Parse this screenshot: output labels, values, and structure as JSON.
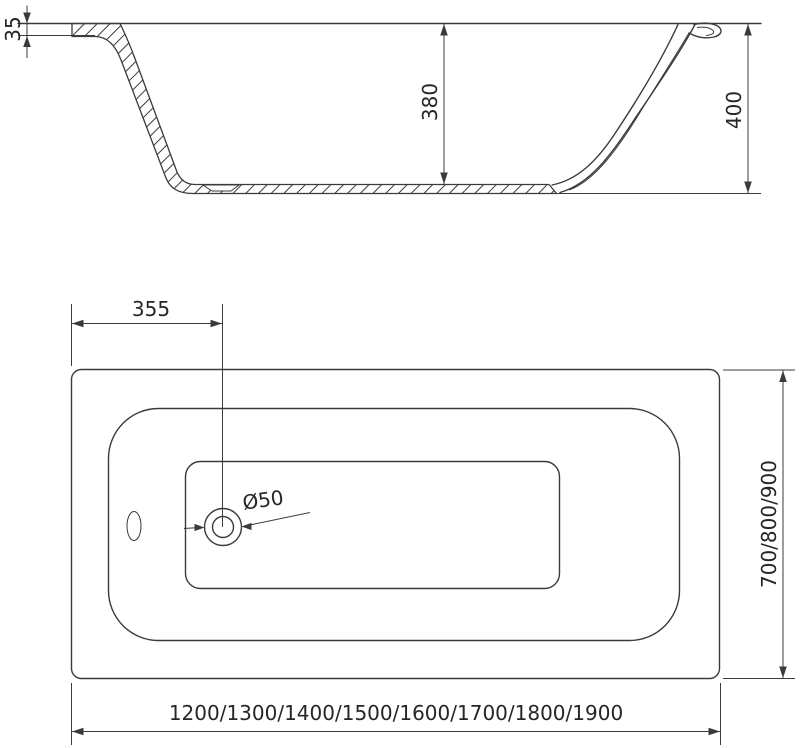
{
  "drawing": {
    "type": "bathtub-technical-drawing",
    "views": {
      "side": {
        "rim_thickness_mm": "35",
        "inner_depth_mm": "380",
        "total_height_mm": "400"
      },
      "plan": {
        "drain_offset_mm": "355",
        "drain_diameter": "Ø50",
        "width_options_mm": "700/800/900",
        "length_options_mm": "1200/1300/1400/1500/1600/1700/1800/1900"
      }
    },
    "colors": {
      "line": "#3b3b3b",
      "dimension": "#3b3b3b",
      "text": "#262626",
      "background": "#ffffff"
    }
  }
}
